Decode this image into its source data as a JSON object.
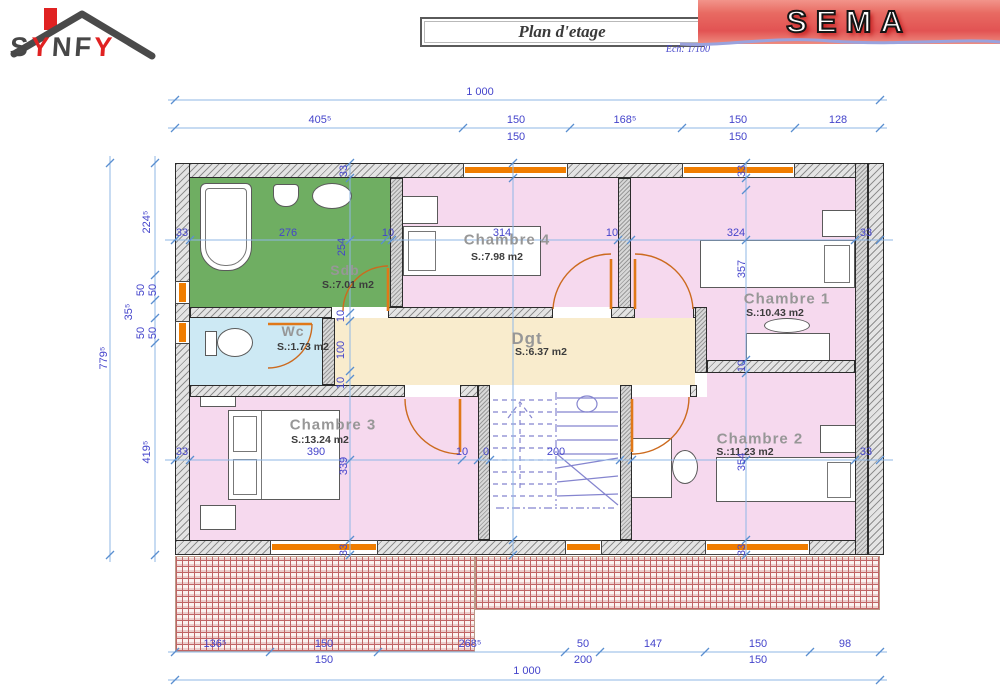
{
  "header": {
    "logo": {
      "text": "SYNFY",
      "letters": [
        {
          "ch": "S",
          "color": "#474747"
        },
        {
          "ch": "Y",
          "color": "#e02222"
        },
        {
          "ch": "N",
          "color": "#474747"
        },
        {
          "ch": "F",
          "color": "#474747"
        },
        {
          "ch": "Y",
          "color": "#e02222"
        }
      ]
    },
    "title": "Plan d'etage",
    "scale_note": "Ech: 1/100",
    "brand": "SEMA"
  },
  "rooms": [
    {
      "id": "sdb",
      "label": "Sdb",
      "area": "S.:7.01 m2",
      "color": "#6fae62"
    },
    {
      "id": "wc",
      "label": "Wc",
      "area": "S.:1.73 m2",
      "color": "#cde9f4"
    },
    {
      "id": "chambre4",
      "label": "Chambre 4",
      "area": "S.:7.98 m2",
      "color": "#f6d9ee"
    },
    {
      "id": "chambre1",
      "label": "Chambre 1",
      "area": "S.:10.43 m2",
      "color": "#f6d9ee"
    },
    {
      "id": "dgt",
      "label": "Dgt",
      "area": "S.:6.37 m2",
      "color": "#f9eccd"
    },
    {
      "id": "chambre3",
      "label": "Chambre 3",
      "area": "S.:13.24 m2",
      "color": "#f6d9ee"
    },
    {
      "id": "chambre2",
      "label": "Chambre 2",
      "area": "S.:11.23 m2",
      "color": "#f6d9ee"
    }
  ],
  "colors": {
    "dimension_line": "#8fb7e6",
    "dimension_text": "#4444cb",
    "window": "#f07d00",
    "door": "#cc6a1e",
    "wall_hatch": "#8f8f8f",
    "roof_hatch": "#c06464",
    "banner_red": "#e25353",
    "logo_red": "#e02222",
    "logo_gray": "#474747"
  },
  "plan": {
    "dims": [
      {
        "t": "1 000",
        "x": 480,
        "y": 92
      },
      {
        "t": "405⁵",
        "x": 320,
        "y": 120
      },
      {
        "t": "150",
        "x": 516,
        "y": 120
      },
      {
        "t": "150",
        "x": 516,
        "y": 137
      },
      {
        "t": "168⁵",
        "x": 625,
        "y": 120
      },
      {
        "t": "150",
        "x": 738,
        "y": 120
      },
      {
        "t": "150",
        "x": 738,
        "y": 137
      },
      {
        "t": "128",
        "x": 838,
        "y": 120
      },
      {
        "t": "779⁵",
        "x": 104,
        "y": 358,
        "r": 1
      },
      {
        "t": "224⁵",
        "x": 147,
        "y": 222,
        "r": 1
      },
      {
        "t": "50",
        "x": 141,
        "y": 290,
        "r": 1
      },
      {
        "t": "50",
        "x": 153,
        "y": 290,
        "r": 1
      },
      {
        "t": "35⁵",
        "x": 129,
        "y": 312,
        "r": 1
      },
      {
        "t": "50",
        "x": 141,
        "y": 333,
        "r": 1
      },
      {
        "t": "50",
        "x": 153,
        "y": 333,
        "r": 1
      },
      {
        "t": "419⁵",
        "x": 147,
        "y": 452,
        "r": 1
      },
      {
        "t": "33",
        "x": 182,
        "y": 233
      },
      {
        "t": "276",
        "x": 288,
        "y": 233
      },
      {
        "t": "10",
        "x": 388,
        "y": 233
      },
      {
        "t": "314",
        "x": 502,
        "y": 233
      },
      {
        "t": "10",
        "x": 612,
        "y": 233
      },
      {
        "t": "324",
        "x": 736,
        "y": 233
      },
      {
        "t": "33",
        "x": 866,
        "y": 233
      },
      {
        "t": "33",
        "x": 344,
        "y": 171,
        "r": 1
      },
      {
        "t": "254",
        "x": 342,
        "y": 247,
        "r": 1
      },
      {
        "t": "10",
        "x": 341,
        "y": 316,
        "r": 1
      },
      {
        "t": "100",
        "x": 341,
        "y": 350,
        "r": 1
      },
      {
        "t": "10",
        "x": 341,
        "y": 383,
        "r": 1
      },
      {
        "t": "339",
        "x": 344,
        "y": 466,
        "r": 1
      },
      {
        "t": "33",
        "x": 344,
        "y": 550,
        "r": 1
      },
      {
        "t": "33",
        "x": 742,
        "y": 171,
        "r": 1
      },
      {
        "t": "357",
        "x": 742,
        "y": 269,
        "r": 1
      },
      {
        "t": "10",
        "x": 742,
        "y": 366,
        "r": 1
      },
      {
        "t": "354",
        "x": 742,
        "y": 462,
        "r": 1
      },
      {
        "t": "33",
        "x": 742,
        "y": 550,
        "r": 1
      },
      {
        "t": "33",
        "x": 182,
        "y": 452
      },
      {
        "t": "390",
        "x": 316,
        "y": 452
      },
      {
        "t": "10",
        "x": 462,
        "y": 452
      },
      {
        "t": "0",
        "x": 486,
        "y": 452
      },
      {
        "t": "200",
        "x": 556,
        "y": 452
      },
      {
        "t": "33",
        "x": 866,
        "y": 452
      },
      {
        "t": "136⁵",
        "x": 215,
        "y": 644
      },
      {
        "t": "150",
        "x": 324,
        "y": 644
      },
      {
        "t": "150",
        "x": 324,
        "y": 660
      },
      {
        "t": "268⁵",
        "x": 470,
        "y": 644
      },
      {
        "t": "50",
        "x": 583,
        "y": 644
      },
      {
        "t": "200",
        "x": 583,
        "y": 660
      },
      {
        "t": "147",
        "x": 653,
        "y": 644
      },
      {
        "t": "150",
        "x": 758,
        "y": 644
      },
      {
        "t": "150",
        "x": 758,
        "y": 660
      },
      {
        "t": "98",
        "x": 845,
        "y": 644
      },
      {
        "t": "1 000",
        "x": 527,
        "y": 671
      }
    ]
  }
}
